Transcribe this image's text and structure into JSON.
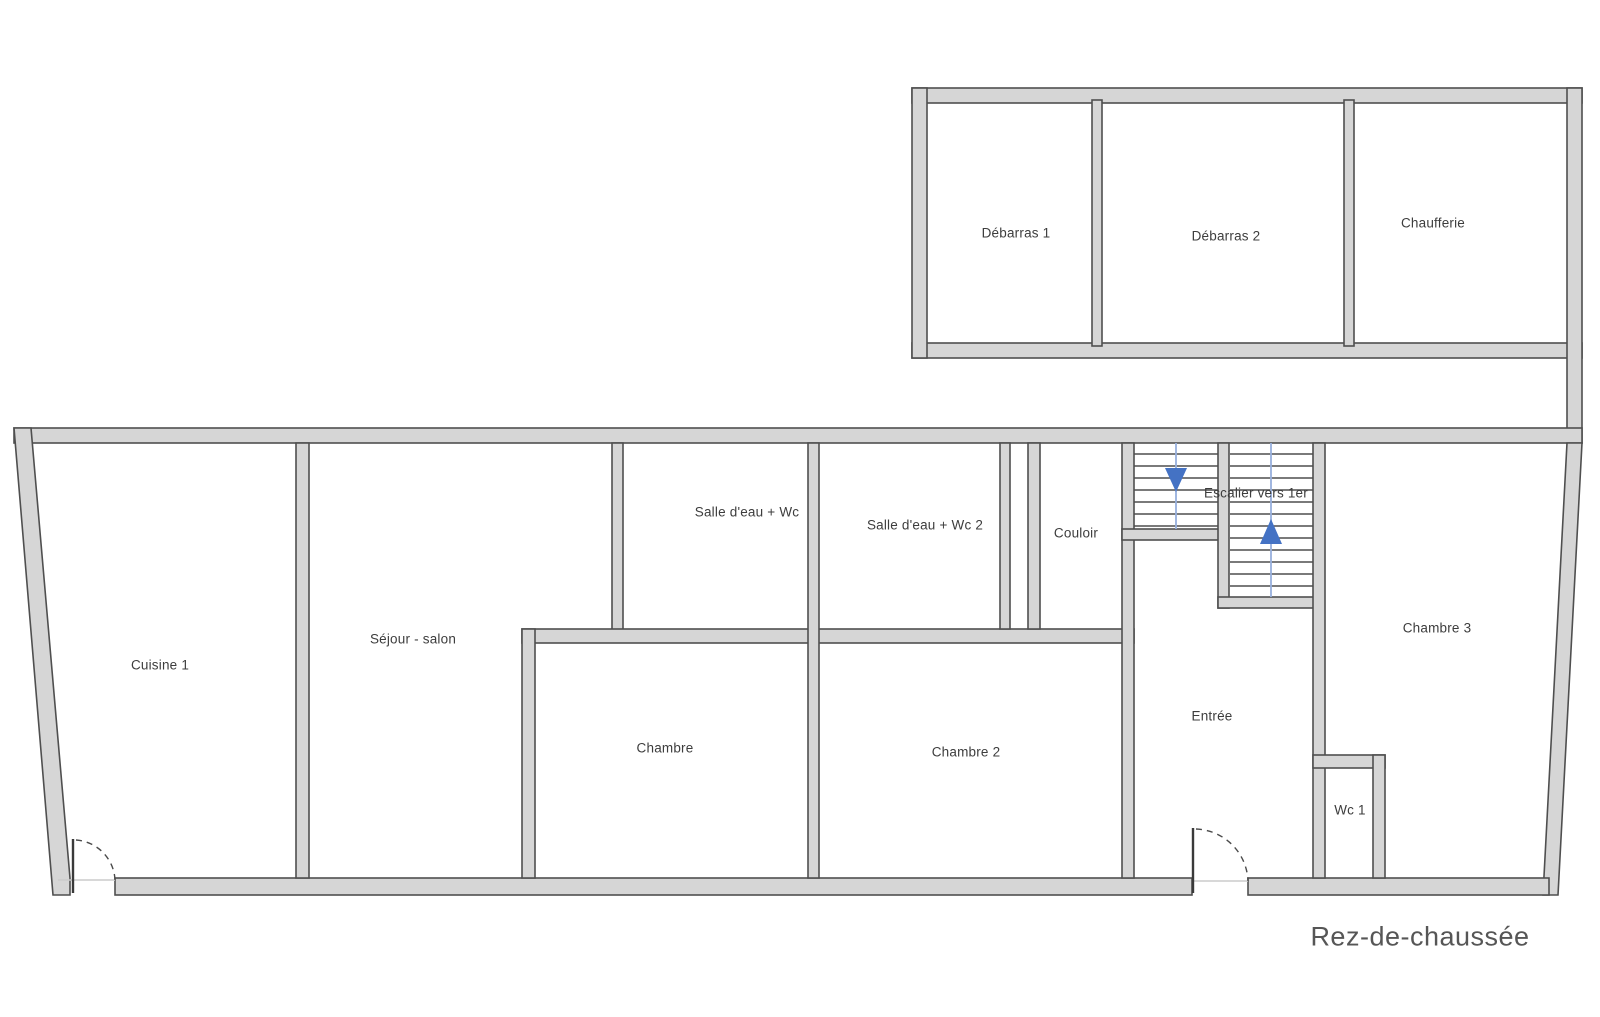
{
  "floorplan": {
    "caption": "Rez-de-chaussée",
    "rooms": {
      "debarras1": "Débarras 1",
      "debarras2": "Débarras 2",
      "chaufferie": "Chaufferie",
      "cuisine": "Cuisine 1",
      "sejour": "Séjour - salon",
      "salle_eau_1": "Salle d'eau + Wc",
      "salle_eau_2": "Salle d'eau + Wc 2",
      "couloir": "Couloir",
      "escalier": "Escalier vers 1er",
      "chambre": "Chambre",
      "chambre2": "Chambre 2",
      "entree": "Entrée",
      "chambre3": "Chambre 3",
      "wc1": "Wc 1"
    },
    "colors": {
      "wall-fill": "#d6d6d6",
      "wall-stroke": "#4f4f4f",
      "stair-arrow": "#4472c4",
      "stair-line": "#97afdc",
      "label-text": "#3d3d3d",
      "caption-text": "#565656",
      "background": "#ffffff"
    }
  }
}
